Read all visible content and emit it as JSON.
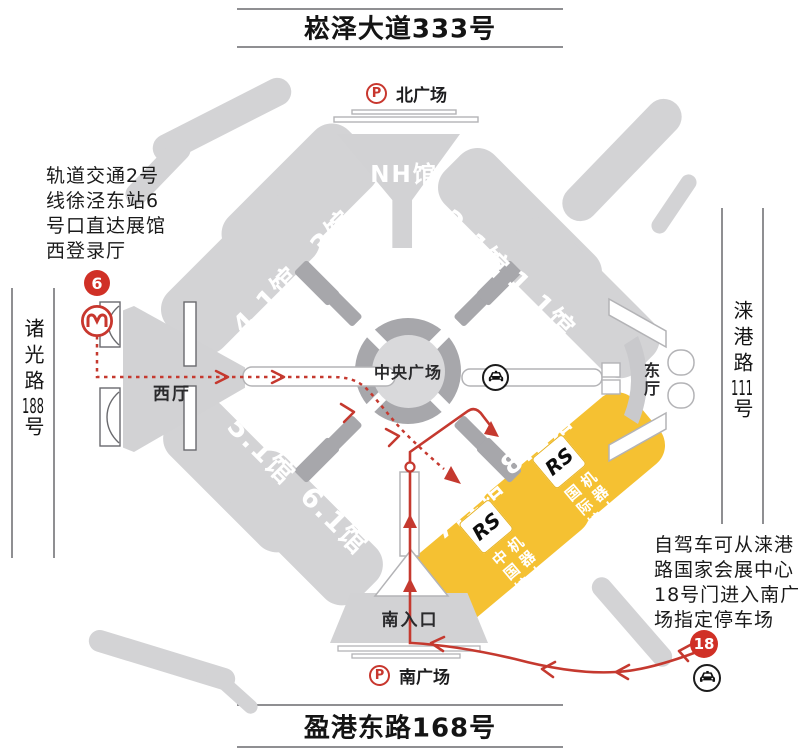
{
  "roads": {
    "north": {
      "name": "崧泽大道333号"
    },
    "south": {
      "name": "盈港东路168号"
    },
    "west": {
      "name": "诸光路",
      "number": "188",
      "suffix": "号"
    },
    "east": {
      "name": "涞港路",
      "number": "111",
      "suffix": "号"
    }
  },
  "plazas": {
    "north": {
      "label": "北广场",
      "parking": "P"
    },
    "south": {
      "label": "南广场",
      "parking": "P"
    },
    "central": {
      "label": "中央广场"
    }
  },
  "halls": {
    "nh": "NH馆",
    "h21": "2.1馆",
    "h11": "1.1馆",
    "h3": "3馆",
    "h41": "4.1馆",
    "h51": "5.1馆",
    "h61": "6.1馆",
    "h71": "7.1馆",
    "h81": "8.1馆"
  },
  "entrances": {
    "west_hall": "西厅",
    "east_hall": "东厅",
    "south_entrance": "南入口"
  },
  "exhibition": {
    "logo": "RS",
    "china_hall": "机器人展\n中国馆",
    "intl_hall": "机器人展\n国际馆"
  },
  "notes": {
    "metro": "轨道交通2号\n线徐泾东站6\n号口直达展馆\n西登录厅",
    "drive": "自驾车可从涞港\n路国家会展中心\n18号门进入南广\n场指定停车场"
  },
  "markers": {
    "metro_exit": "6",
    "gate": "18"
  },
  "colors": {
    "highlight": "#f5c132",
    "hall_gray": "#d3d3d5",
    "connector_gray": "#a7a7ab",
    "route_red": "#c5392f",
    "badge_red": "#d03026"
  }
}
